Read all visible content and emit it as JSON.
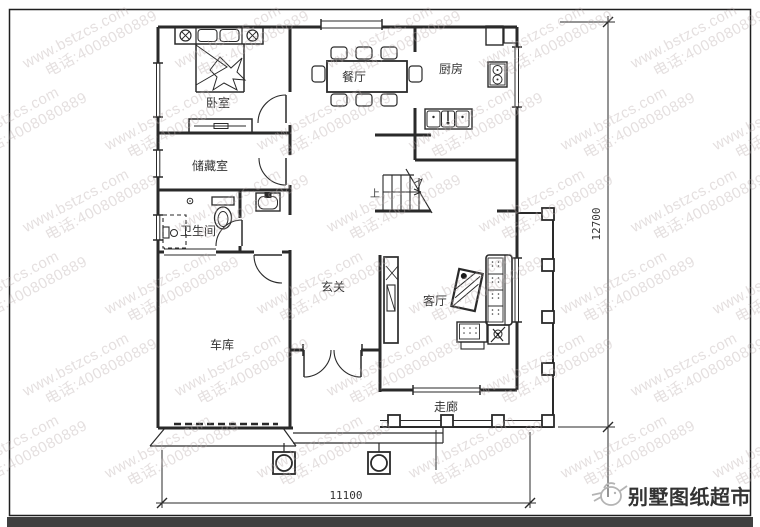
{
  "watermark": {
    "line1": "www.bstzcs.com",
    "line2": "电话:4008080889"
  },
  "plan": {
    "rooms": {
      "bedroom": "卧室",
      "dining": "餐厅",
      "kitchen": "厨房",
      "storage": "储藏室",
      "bathroom": "卫生间",
      "foyer": "玄关",
      "living": "客厅",
      "garage": "车库",
      "corridor": "走廊"
    },
    "stairs_up": "上",
    "dim_width": "11100",
    "dim_height": "12700"
  },
  "footer": {
    "brand": "别墅图纸超市"
  },
  "colors": {
    "line": "#2a2a2a",
    "watermark": "rgba(185,170,170,0.38)",
    "brand": "#b6b6b6",
    "bottom_bar": "#3f3f3f"
  }
}
